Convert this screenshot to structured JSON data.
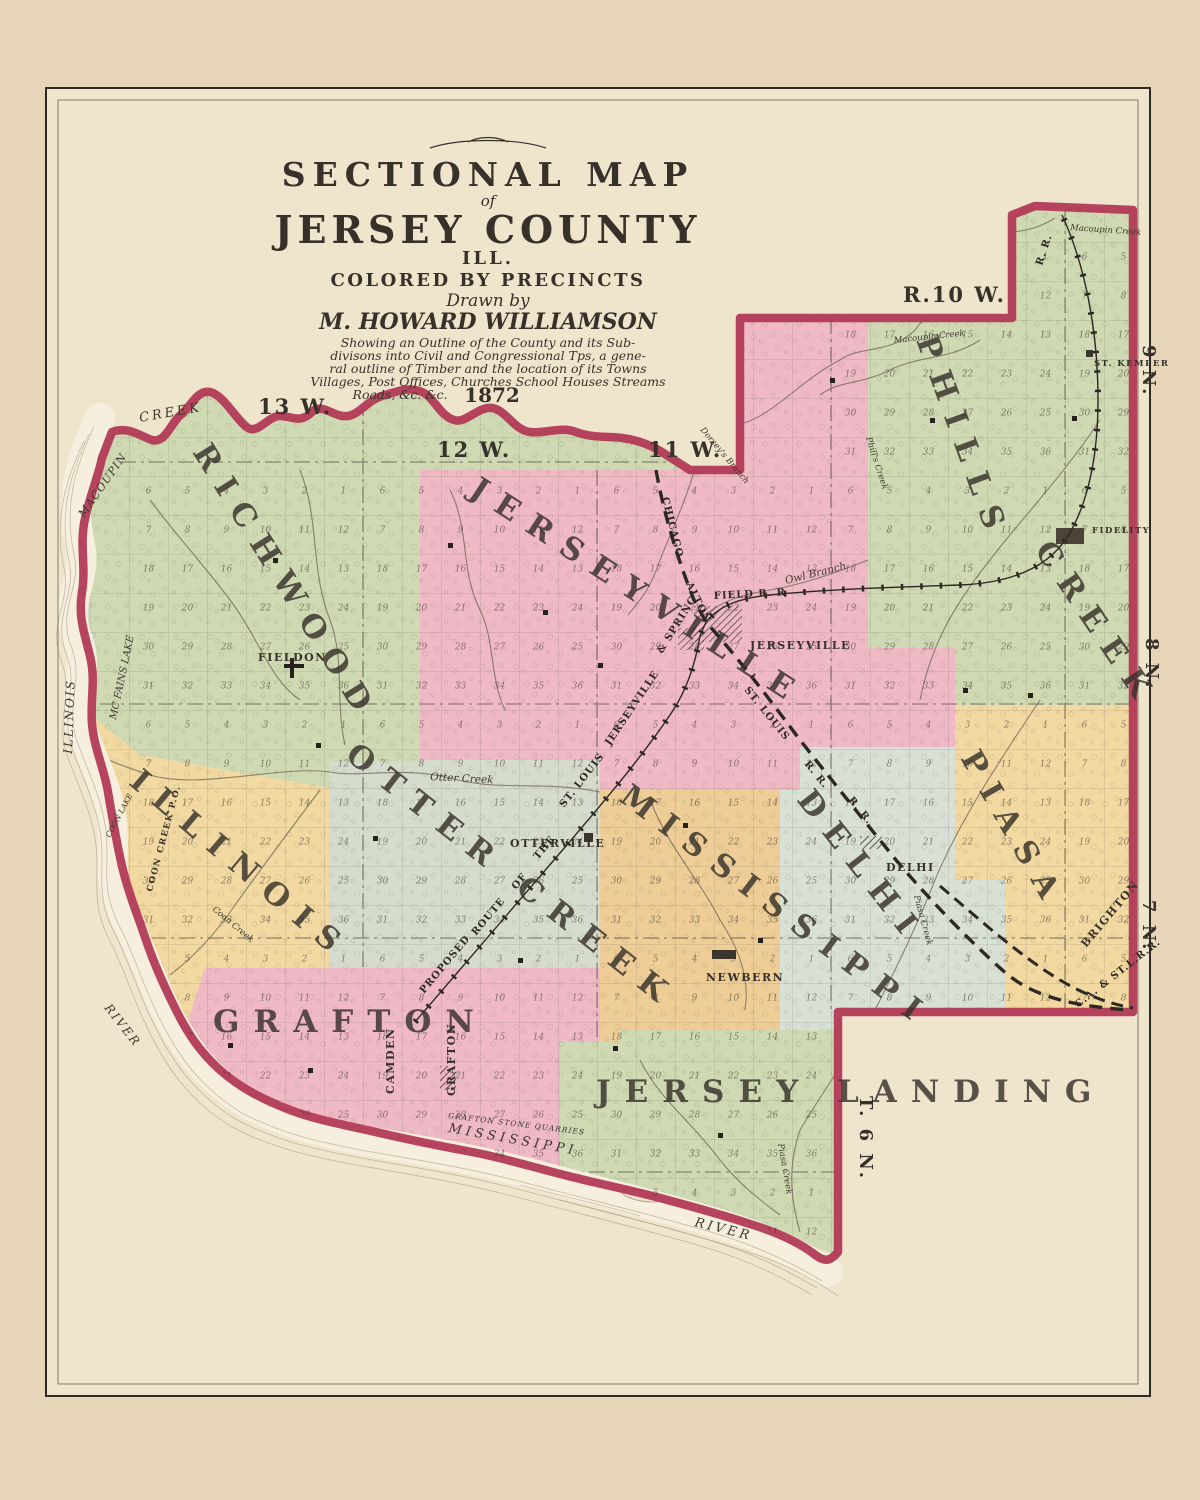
{
  "title_block": {
    "line1": "SECTIONAL MAP",
    "line2": "of",
    "line3": "JERSEY COUNTY",
    "line4": "ILL.",
    "line5": "COLORED BY PRECINCTS",
    "drawn_by": "Drawn by",
    "author": "M. HOWARD WILLIAMSON",
    "desc_lines": [
      "Showing an Outline of the County and its Sub-",
      "divisons into Civil and Congressional Tps, a gene-",
      "ral outline of Timber and the location of its Towns",
      "Villages, Post Offices, Churches School Houses Streams",
      "Roads, &c. &c."
    ],
    "year": "1872"
  },
  "range_labels": {
    "r13": "13 W.",
    "r12": "12 W.",
    "r11": "11 W.",
    "r10": "R.10 W."
  },
  "township_labels": {
    "n9": "9 N.",
    "n8": "8 N.",
    "n7": "7 N.",
    "n6": "T. 6 N."
  },
  "precincts": {
    "richwood": "RICHWOOD",
    "jerseyville": "JERSEYVILLE",
    "phills": "PHILLS",
    "phills_creek": "CREEK",
    "illinois": "ILLINOIS",
    "otter_creek": "OTTER CREEK",
    "mississippi": "MISSISSIPPI",
    "delhi": "DELHI",
    "piasa": "PIASA",
    "grafton": "GRAFTON",
    "jersey_landing": "JERSEY LANDING"
  },
  "towns": {
    "fieldon": "FIELDON",
    "jerseyville": "JERSEYVILLE",
    "otterville": "OTTERVILLE",
    "newbern": "NEWBERN",
    "delhi": "DELHI",
    "fidelity": "FIDELITY",
    "st_kemper": "ST. KEMPER",
    "camden": "CAMDEN",
    "grafton": "GRAFTON",
    "brighton": "BRIGHTON",
    "coon_creek_po": "COON CREEK P.O."
  },
  "water": {
    "macoupin": "MACOUPIN",
    "creek": "CREEK",
    "macoupin_creek_a": "Macoupin Creek",
    "macoupin_creek_b": "Macoupin Creek",
    "mcfains_lake": "MC FAINS LAKE",
    "coon_lake": "COON LAKE",
    "coon_creek": "Coon Creek",
    "otter_creek": "Otter Creek",
    "owl_branch": "Owl Branch",
    "dorseys_branch": "Dorsey's Branch",
    "phills_creek": "Phill's Creek",
    "piasa_creek_a": "Piasa Creek",
    "piasa_creek_b": "Piasa Creek",
    "illinois": "ILLINOIS",
    "river_w": "RIVER",
    "mississippi": "MISSISSIPPI",
    "river_s": "RIVER",
    "quarries": "GRAFTON STONE QUARRIES"
  },
  "railroads": {
    "chicago": "CHICAGO",
    "alton": "ALTON",
    "st_louis": "ST. LOUIS",
    "rr_a": "R. R.",
    "proposed": "PROPOSED",
    "route": "ROUTE",
    "of": "OF",
    "the": "THE",
    "st_louis2": "ST. LOUIS",
    "jerseyville": "JERSEYVILLE",
    "spring": "& SPRING",
    "field_rr": "FIELD R. R",
    "rr_ne": "R. R.",
    "ca_stl": "C.A. & ST.L.R.R.",
    "rr_delhi": "R. R."
  },
  "colors": {
    "paper": "#efe4cc",
    "margin": "#e6d5b8",
    "pink": "#f0b9c6",
    "green": "#cfd9b3",
    "yellow": "#f2d9a2",
    "orange": "#eecd97",
    "slate": "#d6dccd",
    "delhi_blue": "#d9e1d7",
    "boundary": "#b23a56",
    "ink": "#37312a",
    "river_band": "#f6efdd"
  },
  "plss": {
    "cell": 39,
    "numbering": [
      [
        6,
        5,
        4,
        3,
        2,
        1
      ],
      [
        7,
        8,
        9,
        10,
        11,
        12
      ],
      [
        18,
        17,
        16,
        15,
        14,
        13
      ],
      [
        19,
        20,
        21,
        22,
        23,
        24
      ],
      [
        30,
        29,
        28,
        27,
        26,
        25
      ],
      [
        31,
        32,
        33,
        34,
        35,
        36
      ]
    ],
    "origins": [
      [
        831,
        236
      ],
      [
        1065,
        236
      ],
      [
        129,
        470
      ],
      [
        363,
        470
      ],
      [
        597,
        470
      ],
      [
        831,
        470
      ],
      [
        1065,
        470
      ],
      [
        129,
        704
      ],
      [
        363,
        704
      ],
      [
        597,
        704
      ],
      [
        831,
        704
      ],
      [
        1065,
        704
      ],
      [
        129,
        938
      ],
      [
        363,
        938
      ],
      [
        597,
        938
      ],
      [
        831,
        938
      ],
      [
        1065,
        938
      ],
      [
        363,
        1172
      ],
      [
        597,
        1172
      ]
    ]
  }
}
